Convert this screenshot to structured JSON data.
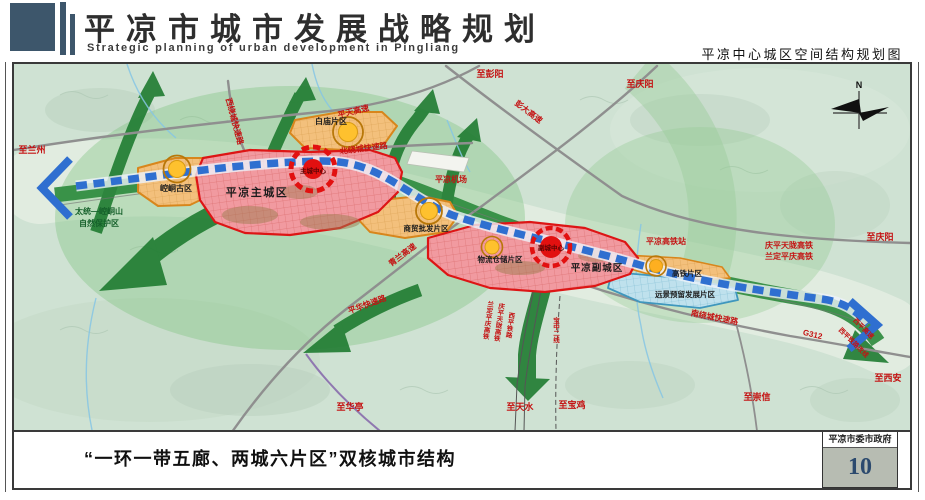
{
  "header": {
    "title_cn": "平凉市城市发展战略规划",
    "title_en": "Strategic planning of urban development in Pingliang",
    "map_title": "平凉中心城区空间结构规划图"
  },
  "caption": {
    "text": "“一环一带五廊、两城六片区”双核城市结构"
  },
  "footer_box": {
    "org": "平凉市委市政府",
    "page": "10"
  },
  "colors": {
    "header_accent": "#3d566b",
    "city_red": "#dd1515",
    "node_yellow": "#fec12e",
    "belt_blue": "#2f6fd0",
    "corridor_green": "#1f7c31",
    "reserved_blue": "#bfe1ed"
  },
  "map": {
    "compass_n": "N",
    "labels": {
      "to_lanzhou": "至兰州",
      "to_pengyang": "至彭阳",
      "to_qingyang_top": "至庆阳",
      "to_qingyang_right": "至庆阳",
      "to_xian": "至西安",
      "to_chongxin": "至崇信",
      "to_huating": "至华亭",
      "to_tianshui": "至天水",
      "to_baoji": "至宝鸡",
      "nature_reserve_line1": "太统—崆峒山",
      "nature_reserve_line2": "自然保护区",
      "airport": "平凉机场",
      "hsr_station": "平凉高铁站",
      "rail_qingping_tianlong": "庆平天陇高铁",
      "rail_landing_pingqing": "兰定平庆高铁",
      "rail_v_ldpq": "兰定平庆高铁",
      "rail_v_qptl": "庆平天陇高铁",
      "rail_v_xiping": "西平铁路",
      "rail_v_baozhong": "宝中二线",
      "road_xiraocheng": "西绕城快速路",
      "road_pingtian": "平天高速",
      "road_beiraocheng": "北绕城快速路",
      "road_pengda": "彭大高速",
      "road_qinglan": "青兰高速",
      "road_nanraocheng": "南绕城快速路",
      "road_g312": "G312",
      "road_xiping_exp": "西平高速",
      "road_xiping_rail": "西平铁路改线",
      "road_pinghua": "平华快速路",
      "area_main_city": "平凉主城区",
      "main_center": "主城中心",
      "area_sub_city": "平凉副城区",
      "sub_center": "副城中心",
      "area_kongtong": "崆峒古区",
      "area_baimiao": "白庙片区",
      "area_shangmao": "商贸批发片区",
      "area_wuliu": "物流仓储片区",
      "area_gaotie": "高铁片区",
      "area_yuanjing": "远景预留发展片区"
    }
  }
}
